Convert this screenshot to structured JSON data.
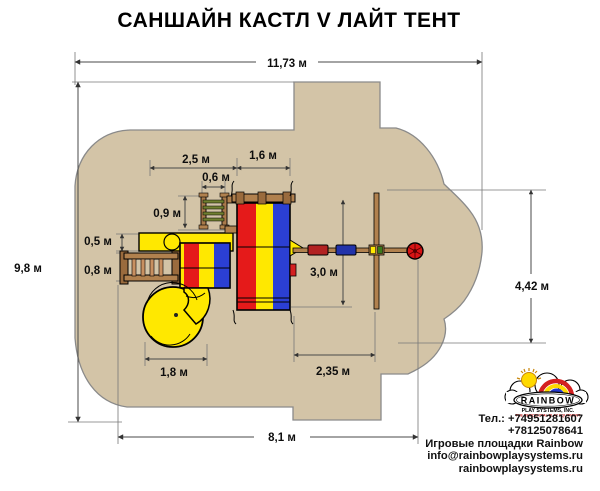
{
  "title": "САНШАЙН КАСТЛ V ЛАЙТ ТЕНТ",
  "dims": {
    "total_width": "11,73 м",
    "total_depth": "9,8 м",
    "left_span": "2,5 м",
    "tent_width": "1,6 м",
    "net_width": "0,6 м",
    "net_depth": "0,9 м",
    "slide_offset": "0,5 м",
    "ladder_depth": "0,8 м",
    "swing_depth": "3,0 м",
    "right_clearance": "4,42 м",
    "spiral_width": "1,8 м",
    "swing_span": "2,35 м",
    "base_span": "8,1 м"
  },
  "logo": {
    "brand": "RAINBOW",
    "company": "PLAY SYSTEMS, INC.",
    "tagline": "THE RESIDENTIAL PLAY EQUIPMENT"
  },
  "contact": {
    "phone1": "Тел.: +74951281607",
    "phone2": "+78125078641",
    "brand_line": "Игровые площадки Rainbow",
    "email": "info@rainbowplaysystems.ru",
    "site": "rainbowplaysystems.ru"
  },
  "colors": {
    "safety_zone": "#d3c4a7",
    "canopy_red": "#e51a1a",
    "canopy_yellow": "#ffe800",
    "canopy_blue": "#2b3fd4",
    "wood": "#b1814e"
  }
}
